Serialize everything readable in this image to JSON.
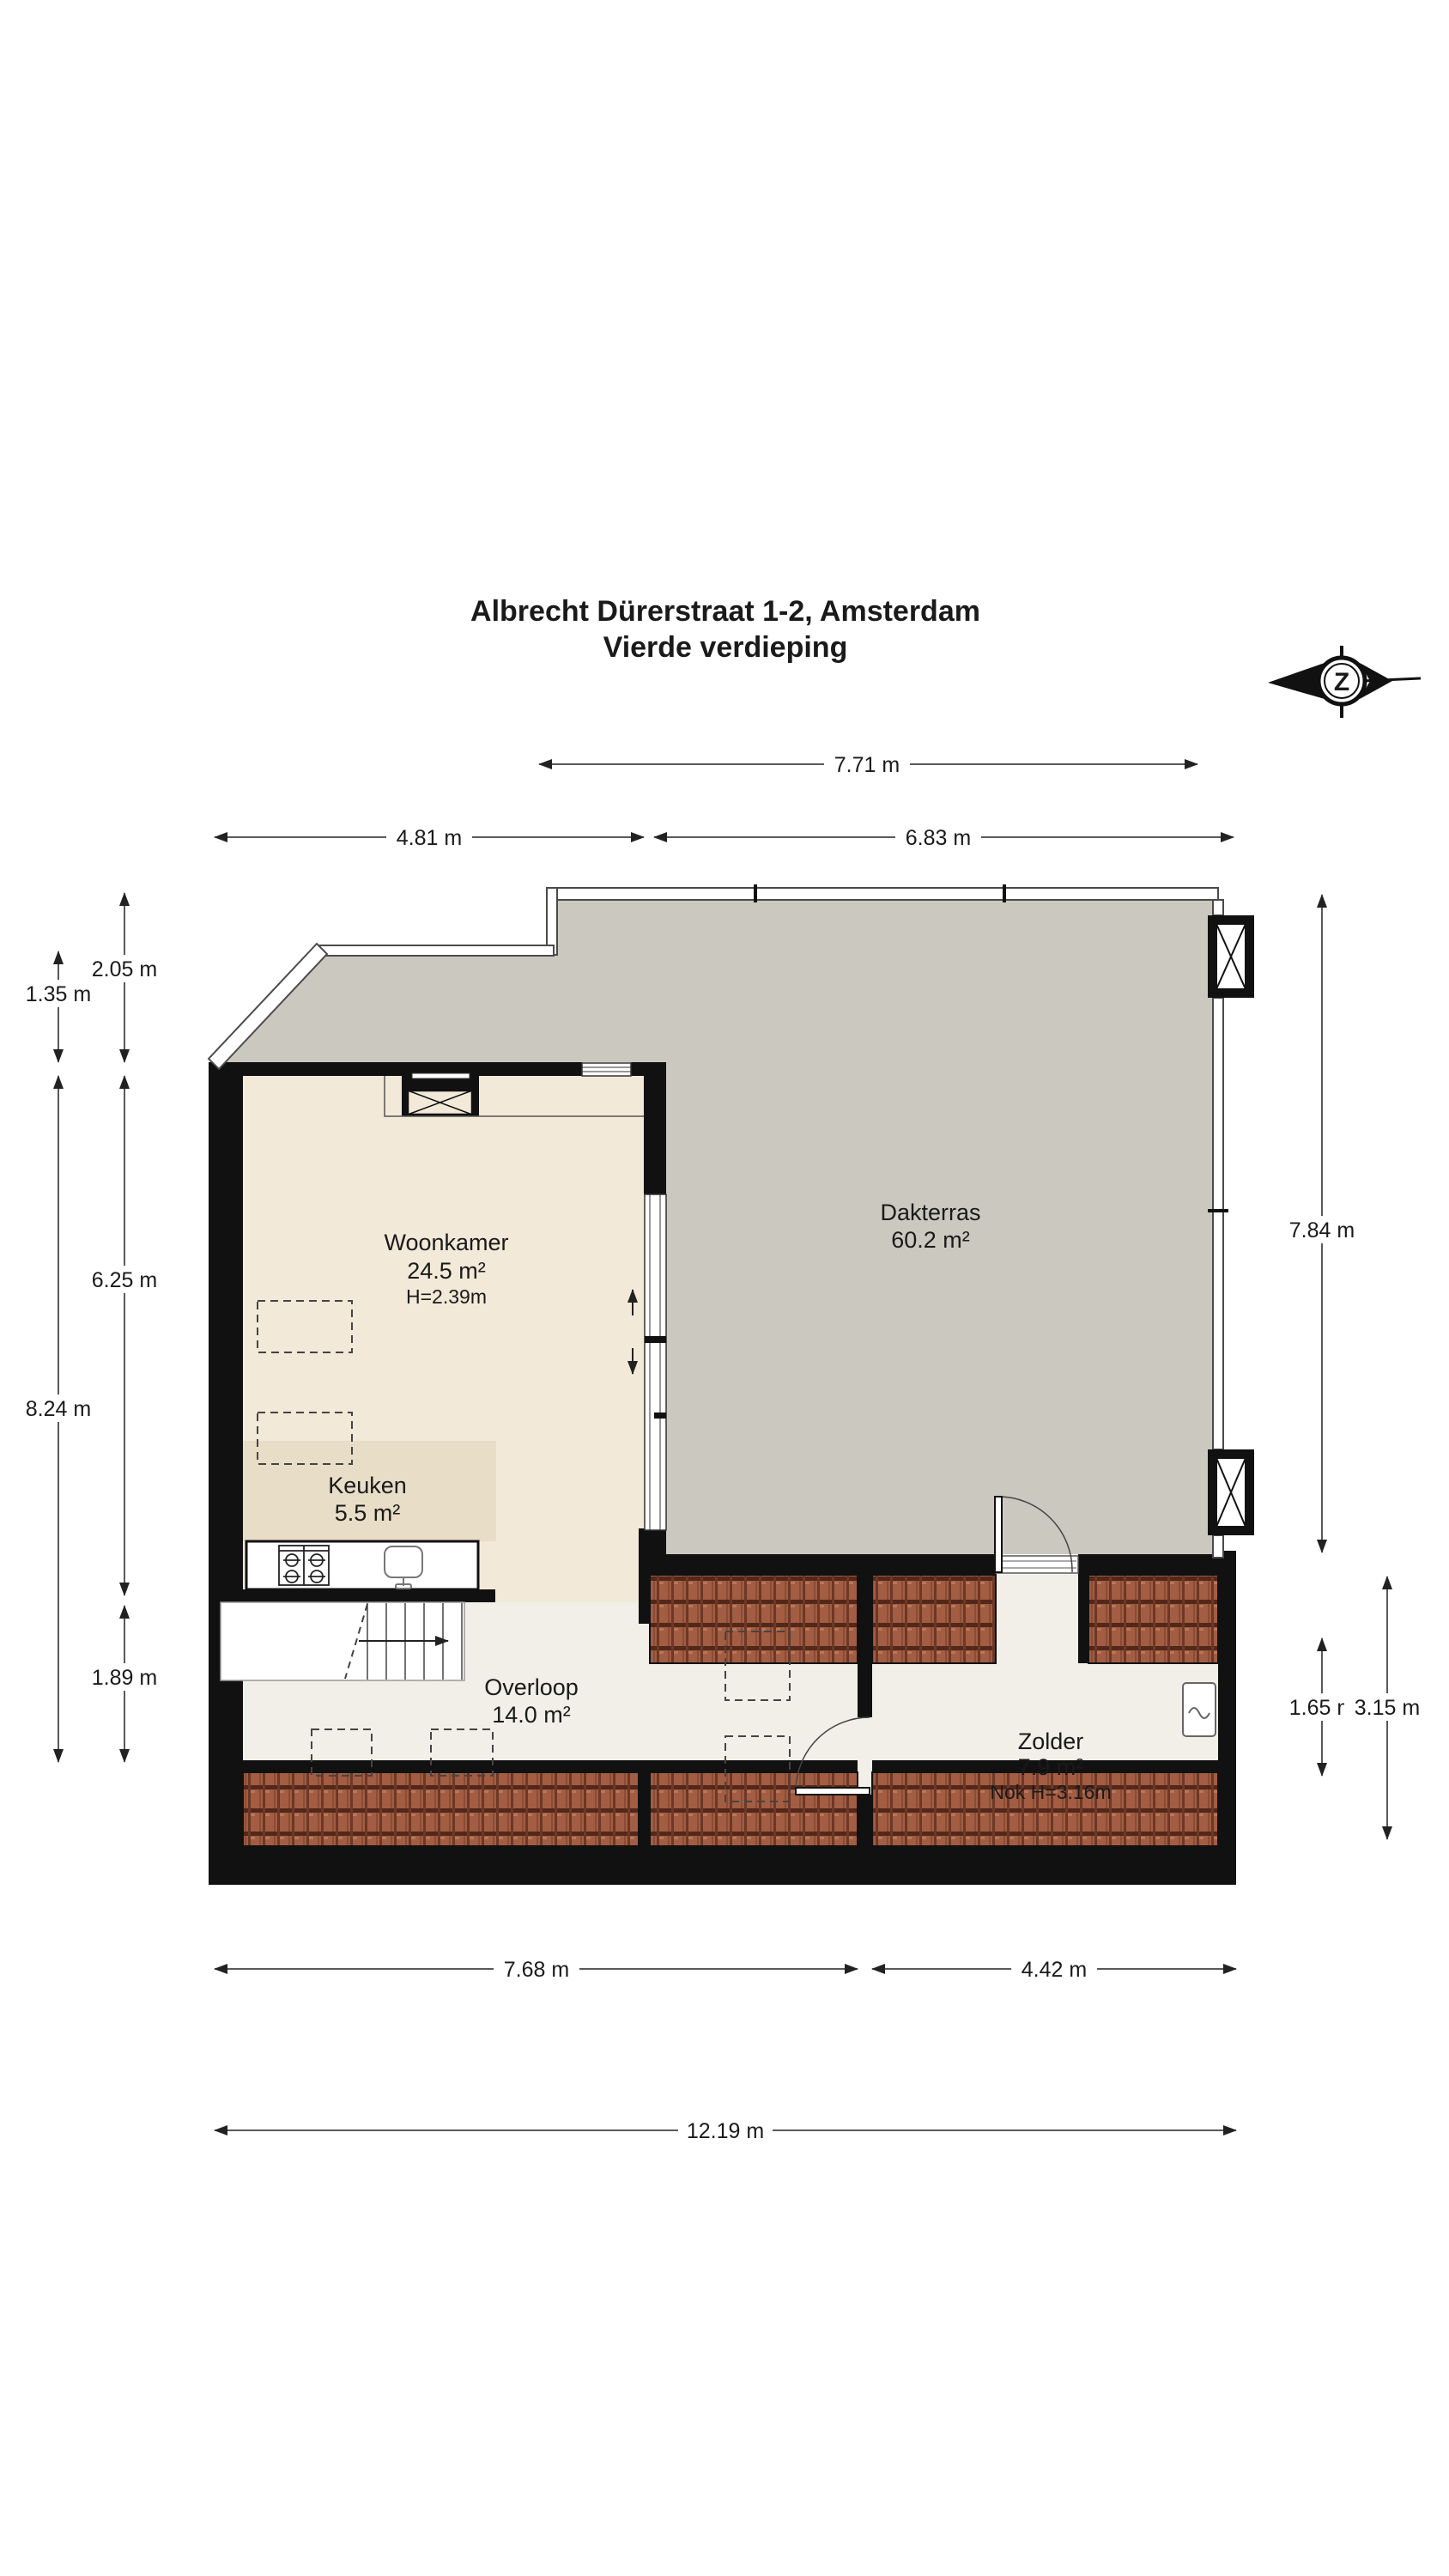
{
  "title": {
    "line1": "Albrecht Dürerstraat 1-2, Amsterdam",
    "line2": "Vierde verdieping"
  },
  "compass": {
    "letter": "Z"
  },
  "rooms": {
    "woonkamer": {
      "name": "Woonkamer",
      "area": "24.5 m²",
      "height": "H=2.39m"
    },
    "dakterras": {
      "name": "Dakterras",
      "area": "60.2 m²"
    },
    "keuken": {
      "name": "Keuken",
      "area": "5.5 m²"
    },
    "overloop": {
      "name": "Overloop",
      "area": "14.0 m²"
    },
    "zolder": {
      "name": "Zolder",
      "area": "7.9 m²",
      "height": "Nok H=3.16m"
    }
  },
  "dimensions": {
    "top_full": "7.71 m",
    "top_left": "4.81 m",
    "top_right": "6.83 m",
    "left_outer_top": "1.35 m",
    "left_outer_main": "8.24 m",
    "left_inner_top": "2.05 m",
    "left_inner_main": "6.25 m",
    "left_inner_bottom": "1.89 m",
    "right_main": "7.84 m",
    "right_zolder": "1.65 m",
    "right_nok": "3.15 m",
    "bottom_left": "7.68 m",
    "bottom_right": "4.42 m",
    "bottom_full": "12.19 m"
  },
  "colors": {
    "wall": "#111111",
    "dakterras_floor": "#cbc8bf",
    "woonkamer_floor": "#f2e9d8",
    "keuken_floor": "#e8ddc7",
    "hall_floor": "#f1efe7",
    "brick": "#a25d43",
    "brick_joint": "#53281a",
    "dimension": "#222222"
  }
}
